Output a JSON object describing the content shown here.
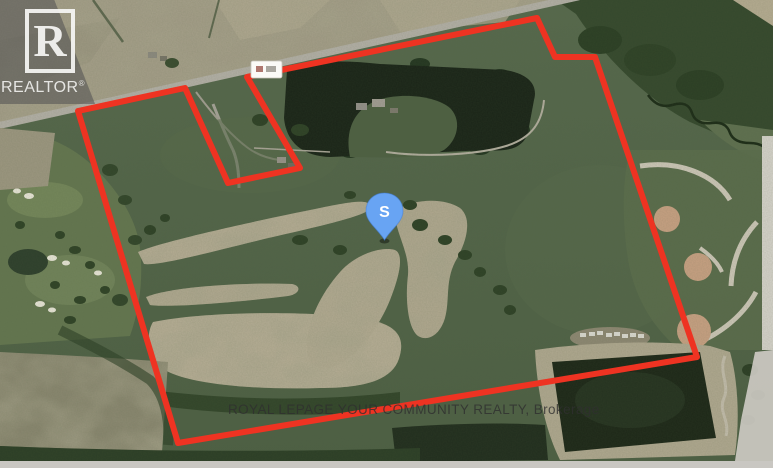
{
  "watermark": {
    "logo_letter": "R",
    "logo_word": "REALTOR",
    "registered_mark": "®"
  },
  "footer": {
    "brokerage": "ROYAL LEPAGE YOUR COMMUNITY REALTY, Brokerage"
  },
  "marker": {
    "label": "S",
    "x": 384.5,
    "y": 240,
    "fill": "#68a4f3"
  },
  "boundary": {
    "color": "#ee3322",
    "stroke_width": 6,
    "points": [
      [
        78,
        111
      ],
      [
        185,
        88
      ],
      [
        228,
        183
      ],
      [
        300,
        168
      ],
      [
        247,
        77
      ],
      [
        537,
        18
      ],
      [
        555,
        57
      ],
      [
        595,
        57
      ],
      [
        697,
        357
      ],
      [
        178,
        443
      ]
    ]
  }
}
